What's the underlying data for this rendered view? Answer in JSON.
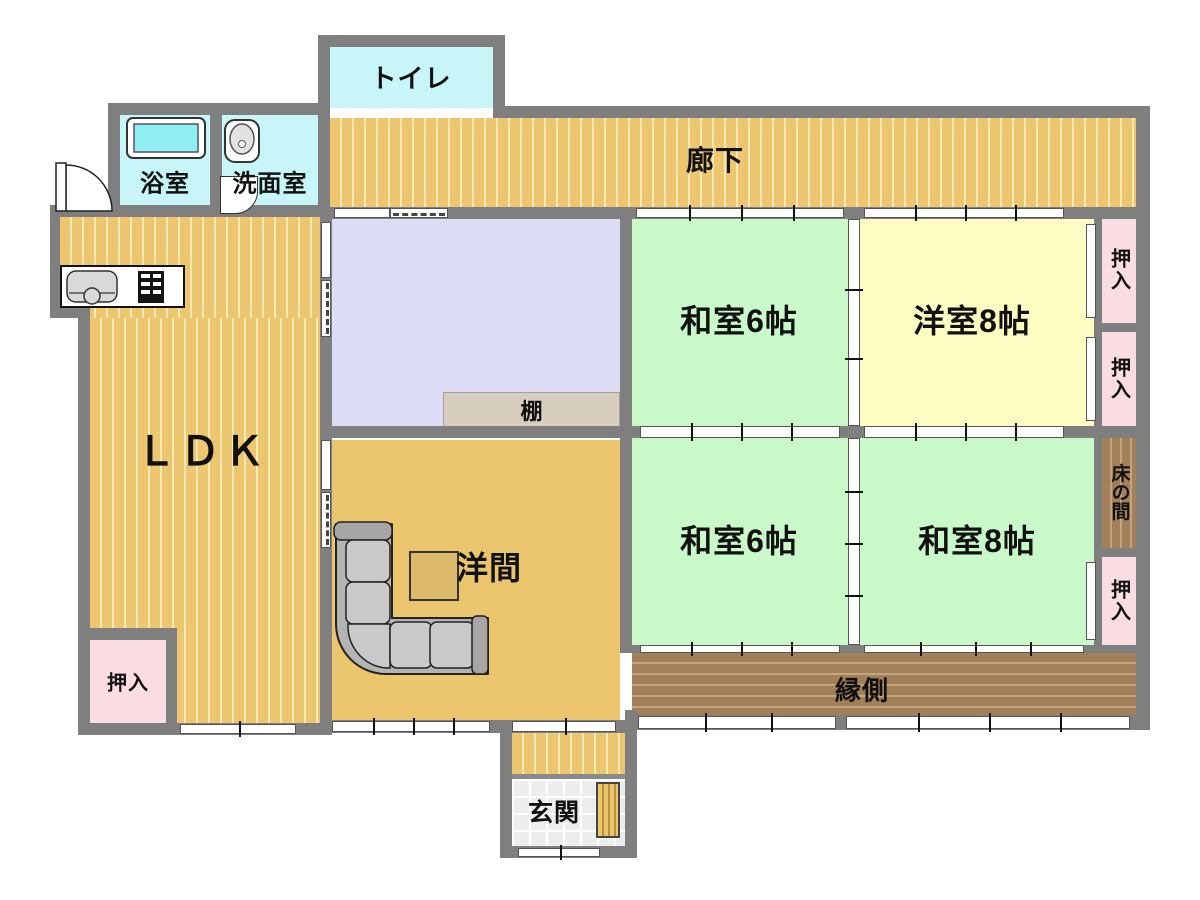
{
  "plan_title": "Japanese house floor plan",
  "palette": {
    "wall_gray": "#7f7f7f",
    "wood_floor": "#ecc76f",
    "wood_stripe": "#f8e9b4",
    "cyan_room": "#c8f6f8",
    "lavender_room": "#dcdcf4",
    "green_tatami": "#c9f8c9",
    "yellow_room": "#fdfcc2",
    "pink_closet": "#fadde2",
    "brown_engawa": "#a2805a",
    "sofa_gray": "#c9c9c9",
    "genkan_tile": "#ededed"
  },
  "rooms": {
    "toilet": {
      "label": "トイレ"
    },
    "bath": {
      "label": "浴室"
    },
    "washroom": {
      "label": "洗面室"
    },
    "corridor": {
      "label": "廊下"
    },
    "ldk": {
      "label": "ＬＤＫ"
    },
    "shelf": {
      "label": "棚"
    },
    "western_room": {
      "label": "洋間"
    },
    "japanese_6_upper": {
      "label": "和室6帖"
    },
    "western_8": {
      "label": "洋室8帖"
    },
    "japanese_6_lower": {
      "label": "和室6帖"
    },
    "japanese_8": {
      "label": "和室8帖"
    },
    "closet_right_1": {
      "label": "押入"
    },
    "closet_right_2": {
      "label": "押入"
    },
    "tokonoma": {
      "label": "床の間"
    },
    "closet_right_3": {
      "label": "押入"
    },
    "closet_ldk": {
      "label": "押入"
    },
    "engawa": {
      "label": "縁側"
    },
    "genkan": {
      "label": "玄関"
    }
  }
}
